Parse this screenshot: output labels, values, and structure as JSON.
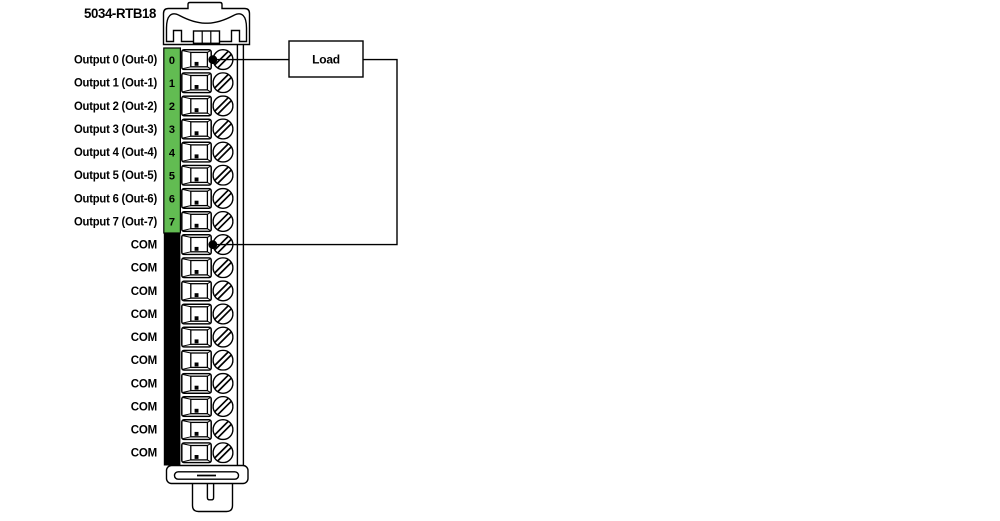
{
  "title": "5034-RTB18",
  "load": {
    "label": "Load"
  },
  "colors": {
    "output_strip": "#62BC52",
    "common_strip": "#000000",
    "line": "#000000",
    "background": "#ffffff"
  },
  "terminals": [
    {
      "num": "0",
      "label": "Output 0 (Out-0)",
      "group": "output",
      "wired": true
    },
    {
      "num": "1",
      "label": "Output 1 (Out-1)",
      "group": "output",
      "wired": false
    },
    {
      "num": "2",
      "label": "Output 2 (Out-2)",
      "group": "output",
      "wired": false
    },
    {
      "num": "3",
      "label": "Output 3 (Out-3)",
      "group": "output",
      "wired": false
    },
    {
      "num": "4",
      "label": "Output 4 (Out-4)",
      "group": "output",
      "wired": false
    },
    {
      "num": "5",
      "label": "Output 5 (Out-5)",
      "group": "output",
      "wired": false
    },
    {
      "num": "6",
      "label": "Output 6 (Out-6)",
      "group": "output",
      "wired": false
    },
    {
      "num": "7",
      "label": "Output 7 (Out-7)",
      "group": "output",
      "wired": false
    },
    {
      "num": "8",
      "label": "COM",
      "group": "common",
      "wired": true
    },
    {
      "num": "9",
      "label": "COM",
      "group": "common",
      "wired": false
    },
    {
      "num": "10",
      "label": "COM",
      "group": "common",
      "wired": false
    },
    {
      "num": "11",
      "label": "COM",
      "group": "common",
      "wired": false
    },
    {
      "num": "12",
      "label": "COM",
      "group": "common",
      "wired": false
    },
    {
      "num": "13",
      "label": "COM",
      "group": "common",
      "wired": false
    },
    {
      "num": "14",
      "label": "COM",
      "group": "common",
      "wired": false
    },
    {
      "num": "15",
      "label": "COM",
      "group": "common",
      "wired": false
    },
    {
      "num": "16",
      "label": "COM",
      "group": "common",
      "wired": false
    },
    {
      "num": "17",
      "label": "COM",
      "group": "common",
      "wired": false
    }
  ],
  "wires": {
    "supply": {
      "from": "terminal-0",
      "to": "load"
    },
    "return": {
      "from": "load",
      "to": "terminal-8"
    }
  }
}
